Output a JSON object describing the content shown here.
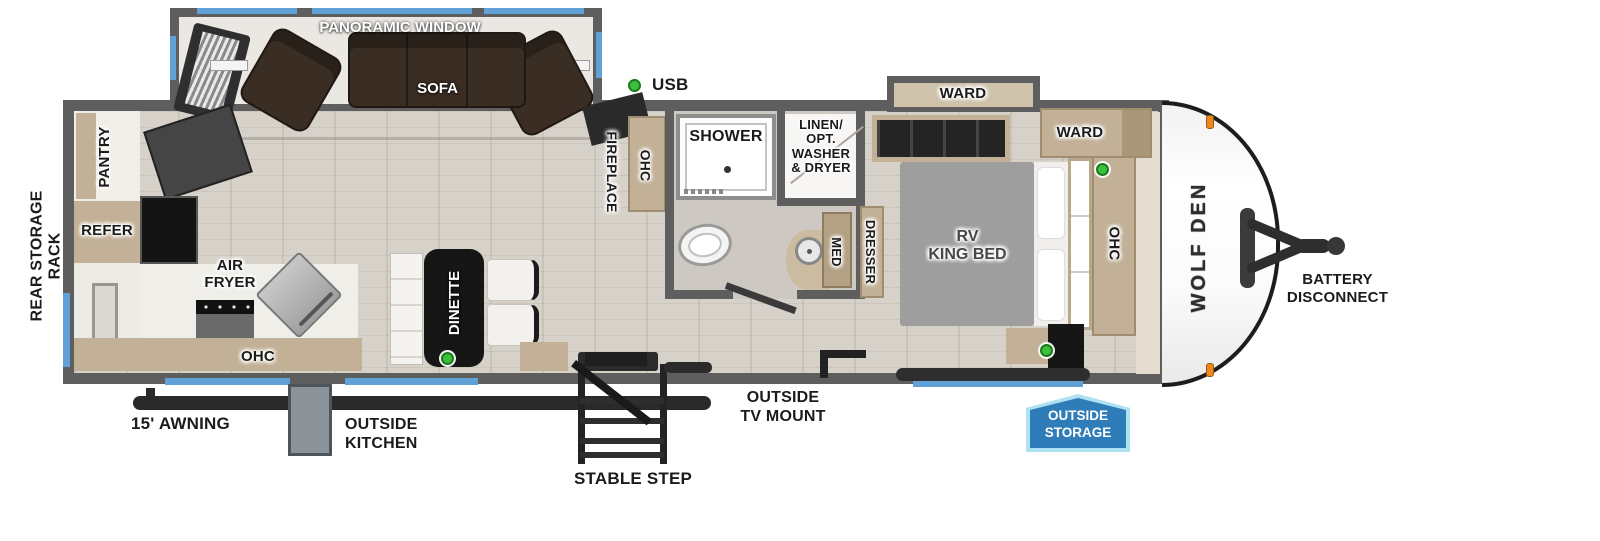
{
  "labels": {
    "rear_storage_rack": "REAR STORAGE RACK",
    "panoramic_window": "PANORAMIC WINDOW",
    "sofa": "SOFA",
    "usb": "USB",
    "pantry": "PANTRY",
    "refer": "REFER",
    "air_fryer": "AIR\nFRYER",
    "kitchen_ohc": "OHC",
    "dinette": "DINETTE",
    "fireplace": "FIREPLACE",
    "hall_ohc": "OHC",
    "shower": "SHOWER",
    "linen_closet": "LINEN/\nOPT.\nWASHER\n& DRYER",
    "med": "MED",
    "dresser": "DRESSER",
    "ward_slide": "WARD",
    "ward_cabinet": "WARD",
    "rv_king_bed": "RV\nKING BED",
    "bedroom_ohc": "OHC",
    "awning": "15' AWNING",
    "outside_kitchen": "OUTSIDE\nKITCHEN",
    "stable_step": "STABLE STEP",
    "outside_tv_mount": "OUTSIDE\nTV MOUNT",
    "outside_storage": "OUTSIDE\nSTORAGE",
    "battery_disconnect": "BATTERY\nDISCONNECT",
    "brand": "WOLF DEN"
  },
  "indicators": {
    "usb_dot_count": 4,
    "usb_dot_color": "#3cc03c",
    "clearance_light_color": "#f0861e"
  },
  "colors": {
    "wall_gray": "#5e5e5e",
    "floor": "#d7d2c9",
    "bath_floor": "#cdc9c2",
    "cabinet_tan": "#c2b197",
    "window_blue": "#62a0d8",
    "sofa_brown": "#3a2d23",
    "bed_gray": "#9e9e9e",
    "table_black": "#161616",
    "storage_badge_blue": "#2e7cb8",
    "storage_badge_border": "#aee2f2"
  }
}
